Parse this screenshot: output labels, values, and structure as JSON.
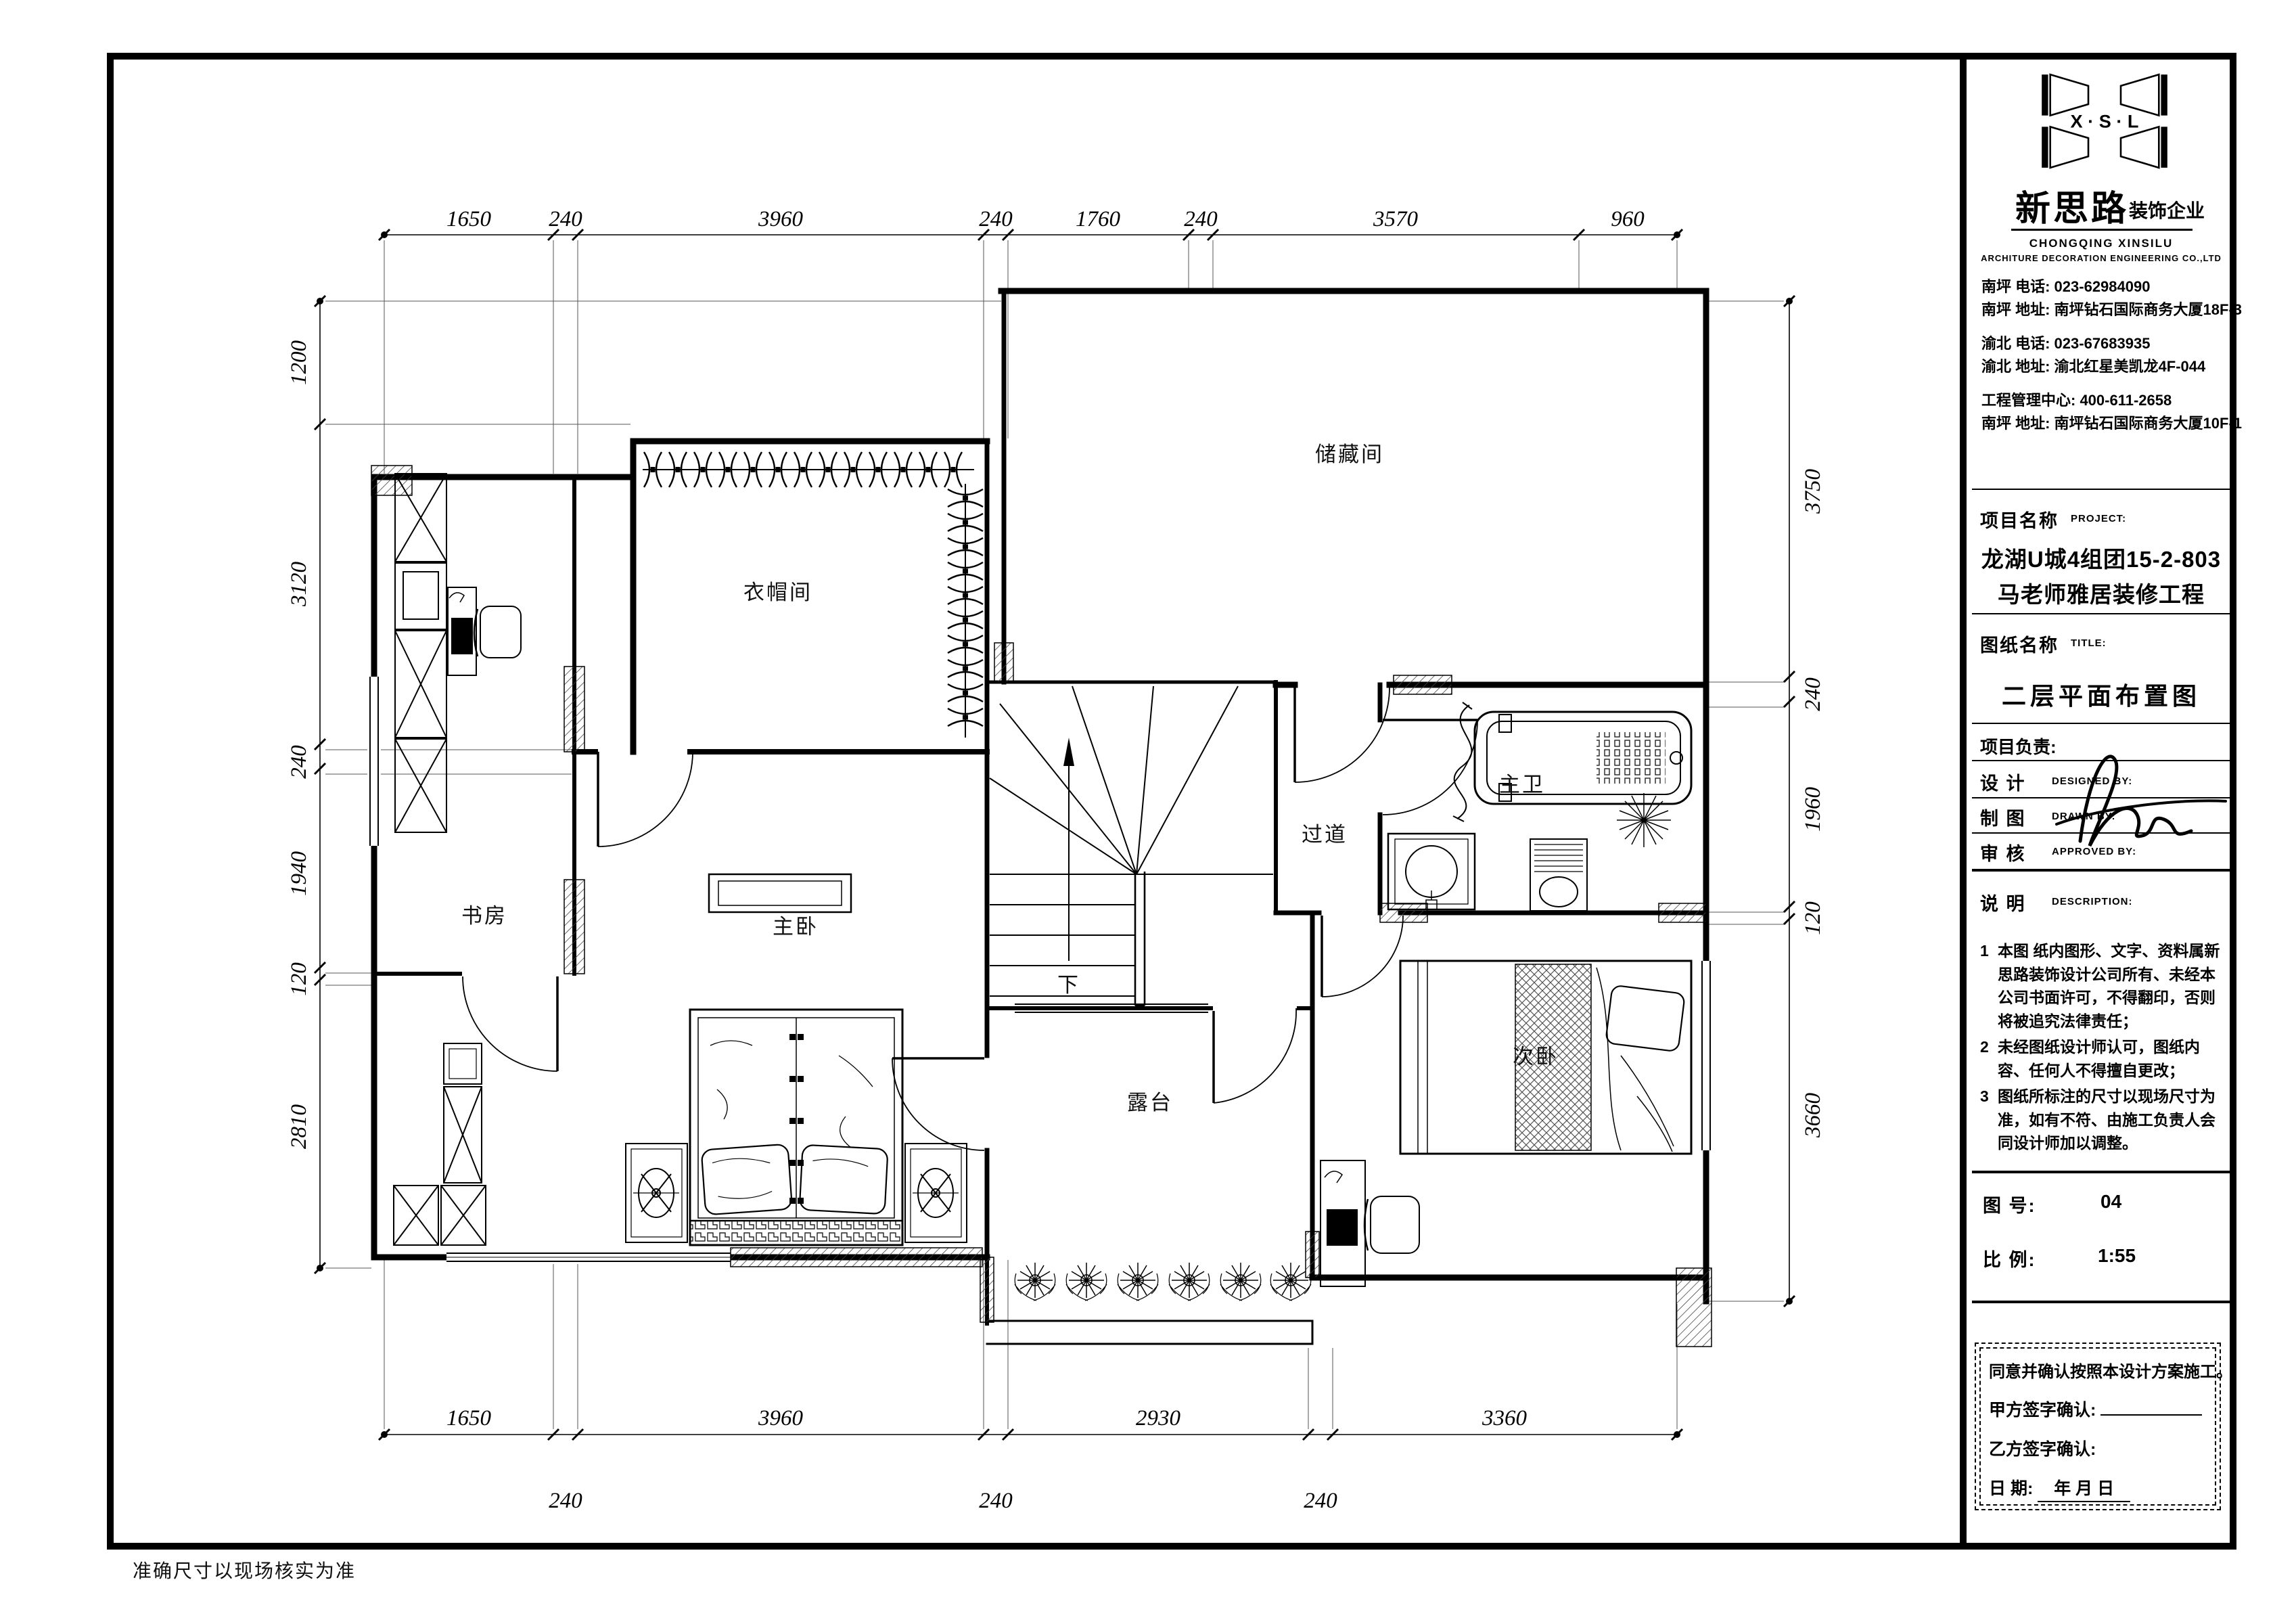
{
  "title_block": {
    "logo": {
      "letters": "X · S · L",
      "company_cn": "新思路",
      "company_suffix": "装饰企业",
      "company_en1": "CHONGQING XINSILU",
      "company_en2": "ARCHITURE DECORATION ENGINEERING CO.,LTD"
    },
    "contacts": [
      "南坪   电话: 023-62984090",
      "南坪   地址: 南坪钻石国际商务大厦18F-3",
      "渝北   电话: 023-67683935",
      "渝北   地址: 渝北红星美凯龙4F-044",
      "工程管理中心: 400-611-2658",
      "南坪   地址: 南坪钻石国际商务大厦10F-1"
    ],
    "project_label": "项目名称",
    "project_label_en": "PROJECT:",
    "project_name_line1": "龙湖U城4组团15-2-803",
    "project_name_line2": "马老师雅居装修工程",
    "sheet_label": "图纸名称",
    "sheet_label_en": "TITLE:",
    "sheet_title": "二层平面布置图",
    "pm_label": "项目负责:",
    "sign_rows": [
      {
        "cn": "设  计",
        "en": "DESIGNED BY:"
      },
      {
        "cn": "制  图",
        "en": "DRAWN BY:"
      },
      {
        "cn": "审  核",
        "en": "APPROVED BY:"
      }
    ],
    "desc_label": "说  明",
    "desc_label_en": "DESCRIPTION:",
    "notes": [
      {
        "num": "1",
        "text": "本图 纸内图形、文字、资料属新思路装饰设计公司所有、未经本公司书面许可，不得翻印，否则将被追究法律责任；"
      },
      {
        "num": "2",
        "text": "未经图纸设计师认可，图纸内容、任何人不得擅自更改；"
      },
      {
        "num": "3",
        "text": "图纸所标注的尺寸以现场尺寸为准，如有不符、由施工负责人会同设计师加以调整。"
      }
    ],
    "fig_no_label": "图  号:",
    "fig_no": "04",
    "scale_label": "比  例:",
    "scale": "1:55",
    "agreement": {
      "line1": "同意并确认按照本设计方案施工。",
      "party_a": "甲方签字确认:",
      "party_b": "乙方签字确认:",
      "date_label": "日       期:",
      "date_suffix": "年   月   日"
    }
  },
  "plan": {
    "rooms": {
      "cloakroom": "衣帽间",
      "storage": "储藏间",
      "study": "书房",
      "master_bedroom": "主卧",
      "corridor": "过道",
      "master_bath": "主卫",
      "second_bedroom": "次卧",
      "terrace": "露台"
    },
    "stair_down_label": "下",
    "dims": {
      "top": [
        "1650",
        "240",
        "3960",
        "240",
        "1760",
        "240",
        "3570",
        "960"
      ],
      "left": [
        "1200",
        "3120",
        "240",
        "1940",
        "120",
        "2810"
      ],
      "right": [
        "3750",
        "240",
        "1960",
        "120",
        "3660"
      ],
      "bottom_main": [
        "1650",
        "3960",
        "2930",
        "3360"
      ],
      "bottom_sub": [
        "240",
        "240",
        "240"
      ]
    },
    "footnote": "准确尺寸以现场核实为准"
  }
}
